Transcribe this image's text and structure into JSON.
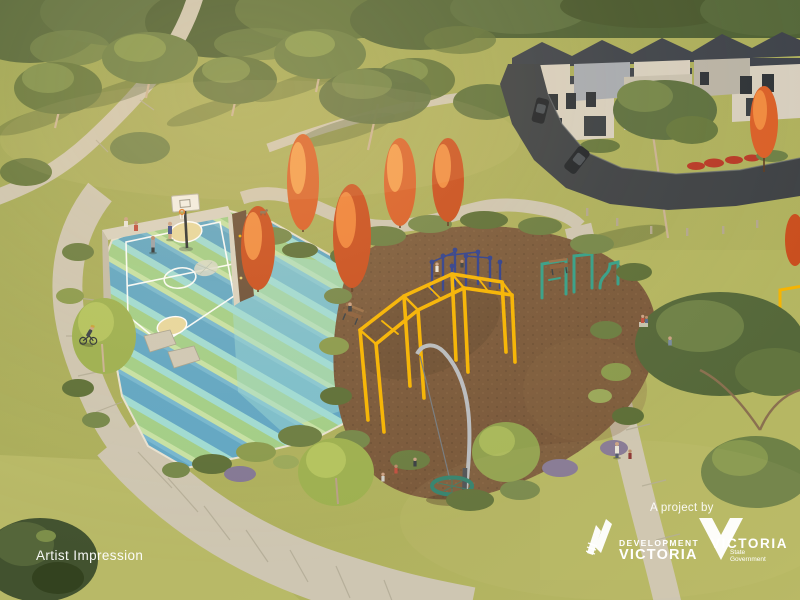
{
  "overlay": {
    "caption": "Artist Impression",
    "credit_prefix": "A project by",
    "dev_vic": {
      "line1": "DEVELOPMENT",
      "line2": "VICTORIA"
    },
    "vic_gov": {
      "line1": "VICTORIA",
      "line2": "State",
      "line3": "Government"
    }
  },
  "icons": {
    "dev_vic": "ribbon-mark",
    "vic_gov": "inverted-triangle-v"
  },
  "scene": {
    "alt": "Aerial artist impression of a neighbourhood park: basketball half-court with striped blue-green surface, mulch playground with yellow monkey bars, blue climbing poles, teal outdoor gym and nest swing, curved concrete paths, autumn orange trees, eucalyptus parkland and a row of townhouses beside a road.",
    "palette": {
      "grass": "#aeb05c",
      "grass_light": "#bcbd6b",
      "canopy": "#55683a",
      "path": "#cec6b2",
      "road": "#3e4246",
      "mulch": "#7a593b",
      "court_blue": "#5ea6c6",
      "court_green": "#a2cf88",
      "court_cyan": "#9fdcd6",
      "court_key": "#e7d79e",
      "equipment_yellow": "#f6b402",
      "equipment_teal": "#35a089",
      "poles_blue": "#2e3f8e",
      "swing_green": "#2e7f6c",
      "house_roof": "#3e434b",
      "house_wall": "#d7cfbf",
      "car": "#22262b",
      "orange_tree": "#d95f28",
      "white": "#ffffff"
    }
  }
}
